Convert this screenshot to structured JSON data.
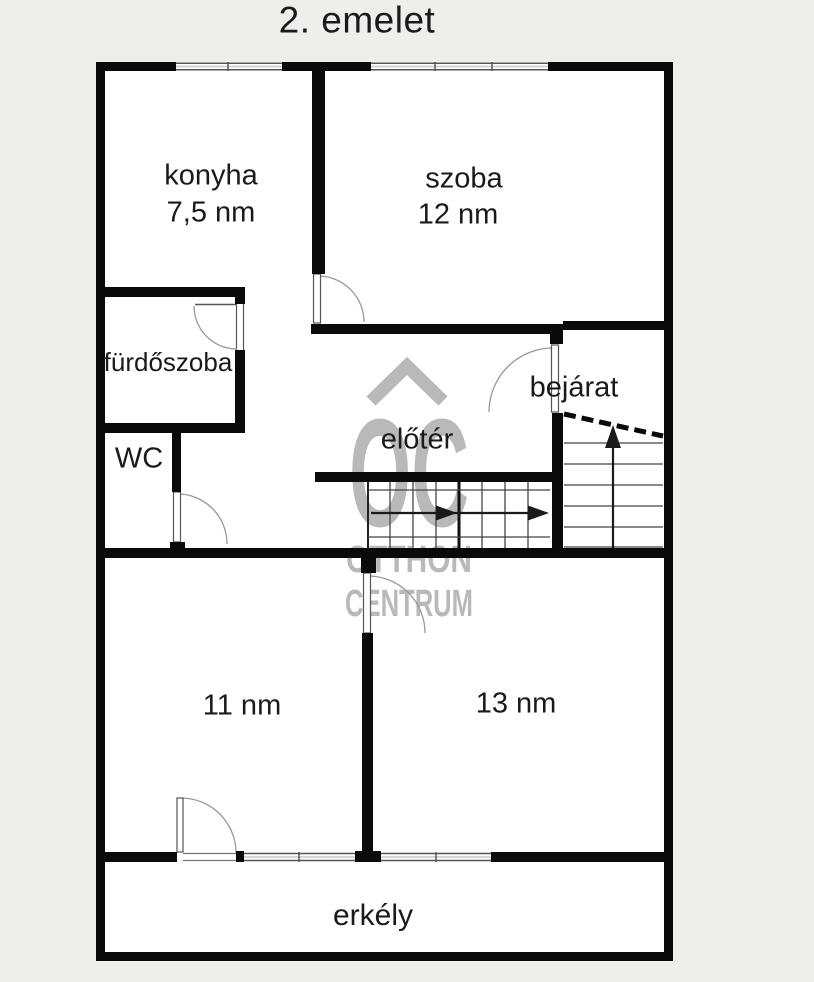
{
  "title": "2. emelet",
  "rooms": {
    "konyha": {
      "name": "konyha",
      "area": "7,5 nm"
    },
    "szoba": {
      "name": "szoba",
      "area": "12 nm"
    },
    "furdoszoba": {
      "name": "fürdőszoba"
    },
    "wc": {
      "name": "WC"
    },
    "eloter": {
      "name": "előtér"
    },
    "bejarat": {
      "name": "bejárat"
    },
    "room11": {
      "area": "11 nm"
    },
    "room13": {
      "area": "13 nm"
    },
    "erkely": {
      "name": "erkély"
    }
  },
  "watermark": {
    "logo": "OC",
    "brand_line1": "OTTHON",
    "brand_line2": "CENTRUM"
  },
  "colors": {
    "background": "#f0eeeb",
    "floor": "#ffffff",
    "wall": "#0a0a0a",
    "thin_line": "#444444",
    "door_arc": "#999999",
    "watermark": "#b9b9b9",
    "text": "#1a1a1a"
  }
}
